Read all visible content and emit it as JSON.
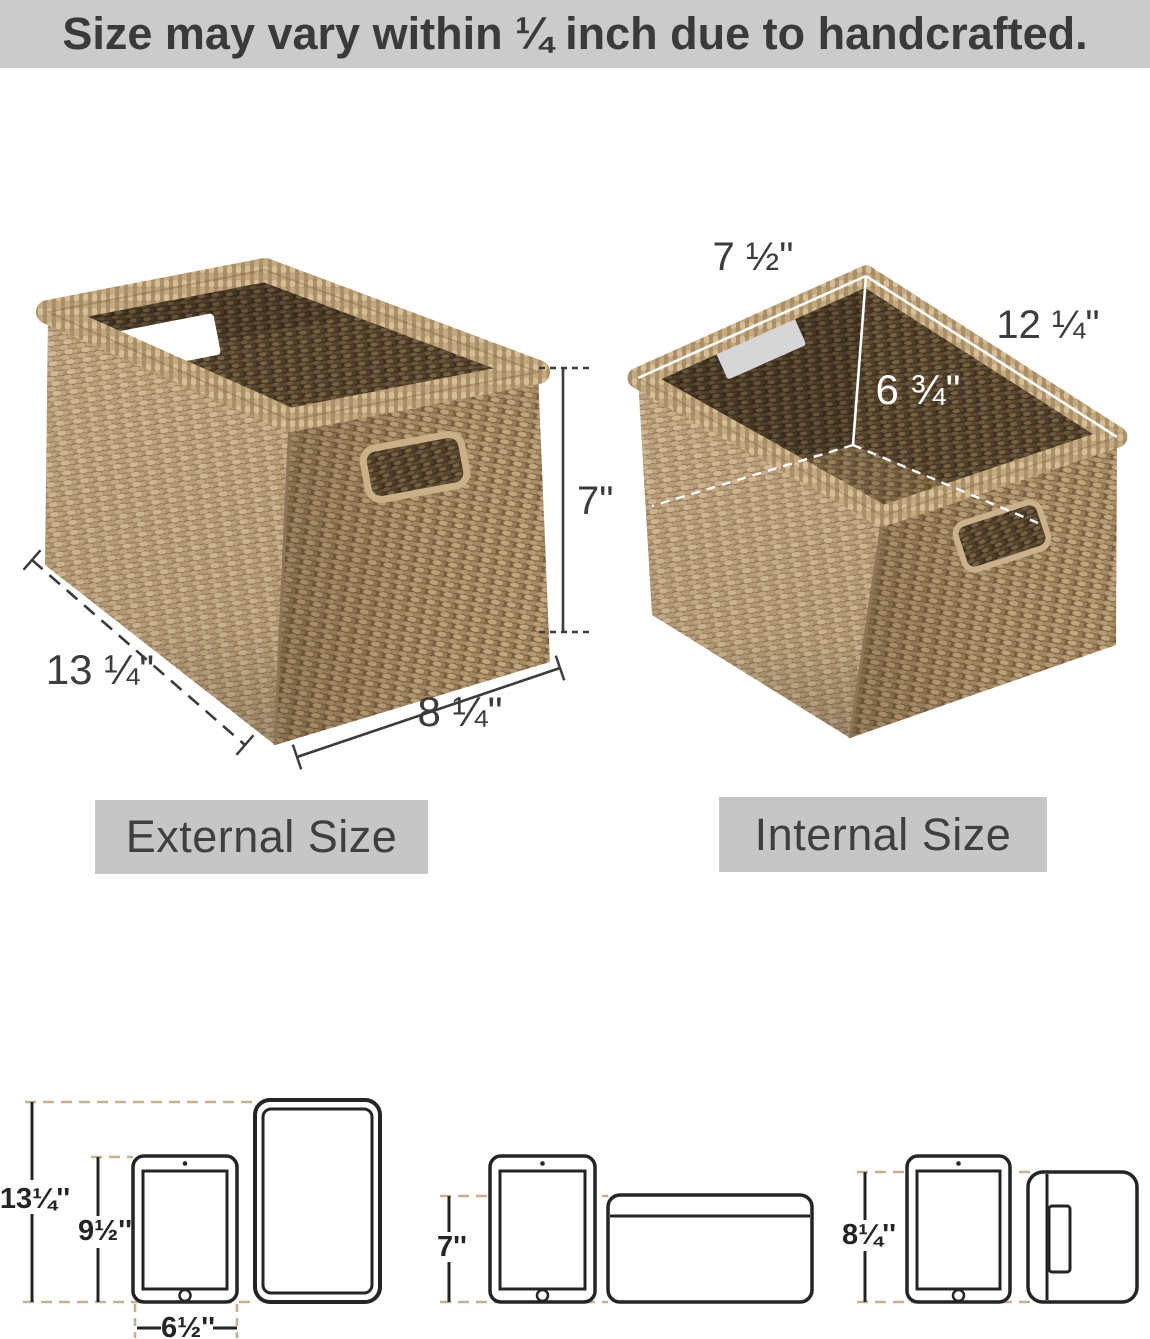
{
  "banner": {
    "text": "Size may vary within ¼ inch due to handcrafted."
  },
  "external_basket": {
    "label": "External Size",
    "length": "13 ¼\"",
    "depth": "8 ¼\"",
    "height": "7\""
  },
  "internal_basket": {
    "label": "Internal Size",
    "front_width": "7 ½\"",
    "length": "12 ¼\"",
    "height": "6 ¾\""
  },
  "fit_guide": {
    "left": {
      "overall_height": "13¼''",
      "tablet_height": "9½''",
      "tablet_width": "6½''"
    },
    "middle": {
      "basket_height": "7''"
    },
    "right": {
      "basket_height": "8¼''"
    }
  },
  "colors": {
    "banner_bg": "#cbcbcb",
    "size_label_bg": "#c6c6c6",
    "text_dark": "#3a3a3a",
    "diagram_line_dark": "#242424",
    "dash_tan": "#c3b191",
    "dimension_white": "#ffffff",
    "weave_light": "#c9ae88",
    "weave_shadow": "#7b6243",
    "weave_interior": "#3f3120",
    "rim_light": "#d5bd96"
  }
}
